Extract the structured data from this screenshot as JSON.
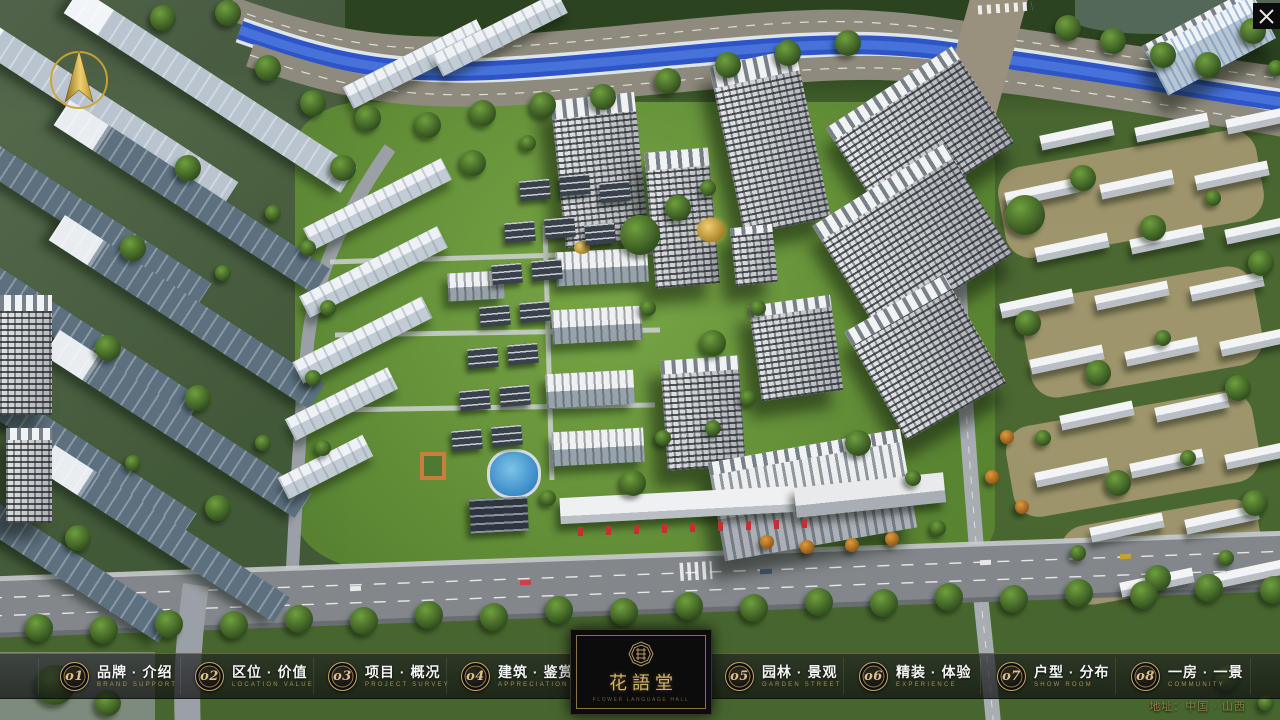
{
  "project": {
    "name": "花語堂",
    "name_subtitle": "FLOWER LANGUAGE HALL"
  },
  "menu": {
    "items": [
      {
        "num": "o1",
        "title": "品牌 · 介绍",
        "subtitle": "BRAND SUPPORT"
      },
      {
        "num": "o2",
        "title": "区位 · 价值",
        "subtitle": "LOCATION VALUE"
      },
      {
        "num": "o3",
        "title": "项目 · 概况",
        "subtitle": "PROJECT SURVEY"
      },
      {
        "num": "o4",
        "title": "建筑 · 鉴赏",
        "subtitle": "APPRECIATION"
      },
      {
        "num": "o5",
        "title": "园林 · 景观",
        "subtitle": "GARDEN STREET"
      },
      {
        "num": "o6",
        "title": "精装 · 体验",
        "subtitle": "EXPERIENCE"
      },
      {
        "num": "o7",
        "title": "户型 · 分布",
        "subtitle": "SHOW ROOM"
      },
      {
        "num": "o8",
        "title": "一房 · 一景",
        "subtitle": "COMMUNITY"
      }
    ]
  },
  "footer": {
    "address": "地址：中国 · 山西"
  }
}
